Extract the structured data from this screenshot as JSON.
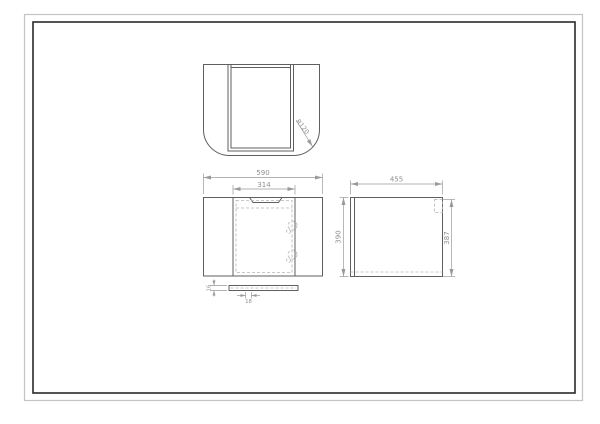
{
  "colors": {
    "background": "#ffffff",
    "border_outer": "#c4c4c4",
    "border_inner": "#2a2a2a",
    "line": "#5f5f5f",
    "hidden": "#b5b5b5",
    "dimension": "#9a9a9a",
    "text": "#8f8f8f"
  },
  "views": {
    "top": {
      "radius": "R120"
    },
    "front": {
      "overall_width": "590",
      "door_width": "314",
      "strip_thickness": "16",
      "strip_width": "18"
    },
    "side": {
      "depth": "455",
      "height_left": "390",
      "height_right": "387"
    }
  }
}
